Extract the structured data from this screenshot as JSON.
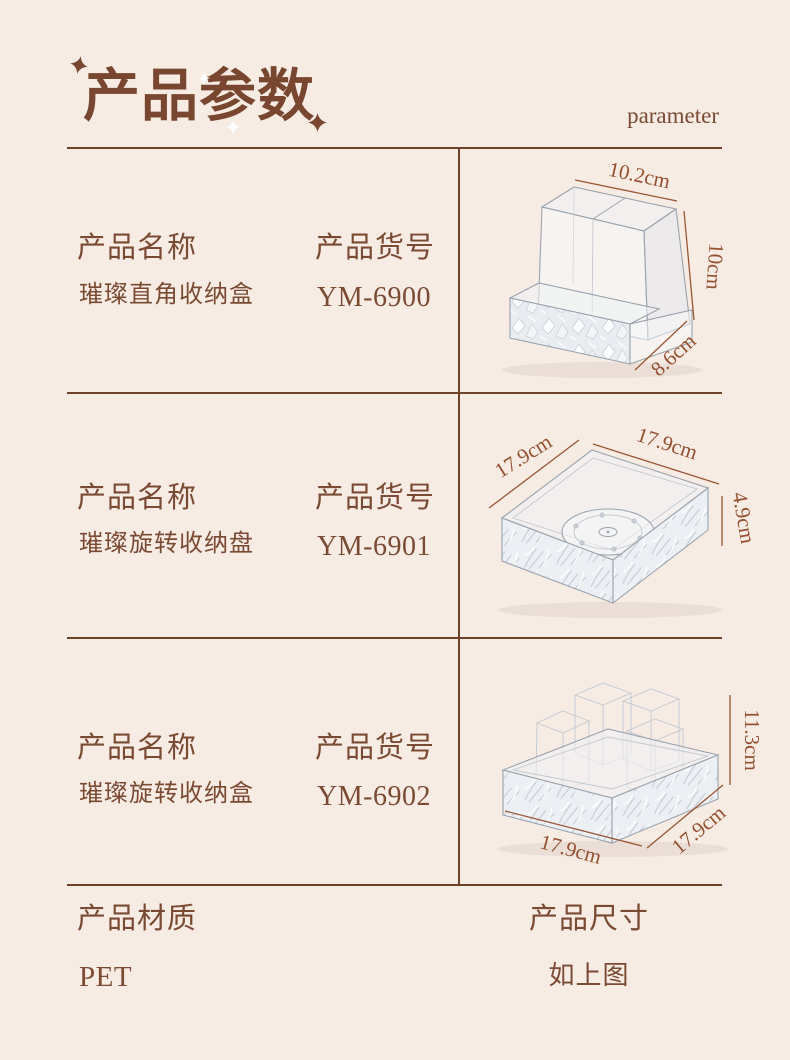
{
  "page": {
    "title": "产品参数",
    "subtitle": "parameter"
  },
  "colors": {
    "background": "#f6ece4",
    "text_brown": "#7b4a33",
    "table_line": "#6e4129",
    "dimension_brown": "#95502f"
  },
  "rows": [
    {
      "name_label": "产品名称",
      "name_value": "璀璨直角收纳盒",
      "sku_label": "产品货号",
      "sku_value": "YM-6900",
      "image_alt": "clear two-compartment organizer with textured front tray",
      "dims": {
        "width": "10.2cm",
        "height": "10cm",
        "depth": "8.6cm"
      }
    },
    {
      "name_label": "产品名称",
      "name_value": "璀璨旋转收纳盘",
      "sku_label": "产品货号",
      "sku_value": "YM-6901",
      "image_alt": "clear square rotating tray with textured sides and turntable base",
      "dims": {
        "left": "17.9cm",
        "top": "17.9cm",
        "height": "4.9cm"
      }
    },
    {
      "name_label": "产品名称",
      "name_value": "璀璨旋转收纳盒",
      "sku_label": "产品货号",
      "sku_value": "YM-6902",
      "image_alt": "clear square textured box with tall compartments",
      "dims": {
        "height": "11.3cm",
        "front": "17.9cm",
        "side": "17.9cm"
      }
    }
  ],
  "footer": {
    "material_label": "产品材质",
    "material_value": "PET",
    "size_label": "产品尺寸",
    "size_value": "如上图"
  }
}
